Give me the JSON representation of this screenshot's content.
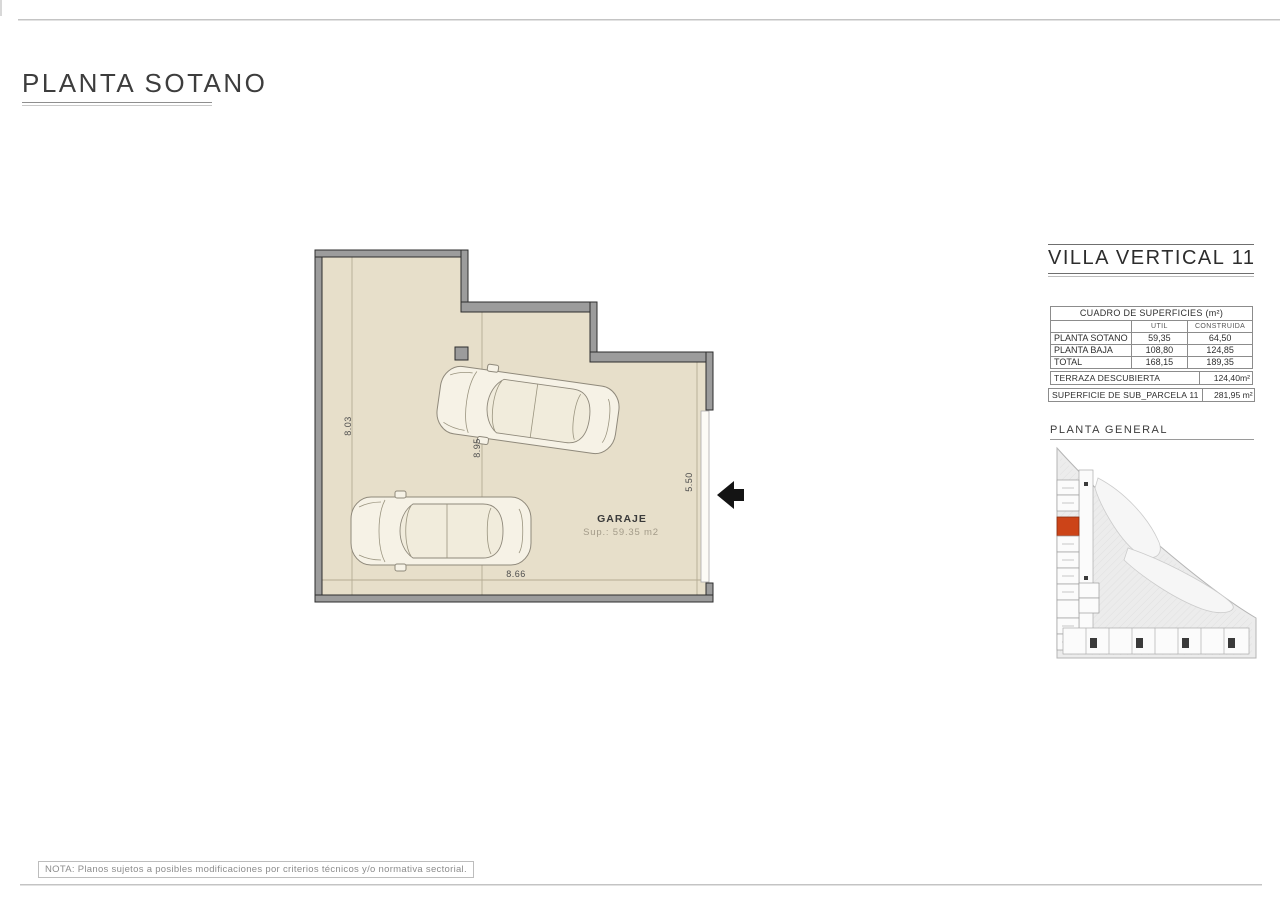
{
  "sheet": {
    "title": "PLANTA SOTANO",
    "note": "NOTA: Planos sujetos a posibles modificaciones por criterios técnicos y/o normativa sectorial."
  },
  "plan": {
    "room_label": "GARAJE",
    "room_area": "Sup.: 59.35 m2",
    "dims": {
      "left": "8.03",
      "inner": "8.95",
      "right": "5.50",
      "bottom": "8.66"
    }
  },
  "panel": {
    "title": "VILLA VERTICAL 11",
    "table": {
      "title": "CUADRO DE SUPERFICIES (m²)",
      "col_headers": [
        "UTIL",
        "CONSTRUIDA"
      ],
      "rows": [
        {
          "label": "PLANTA SOTANO",
          "util": "59,35",
          "construida": "64,50"
        },
        {
          "label": "PLANTA BAJA",
          "util": "108,80",
          "construida": "124,85"
        },
        {
          "label": "TOTAL",
          "util": "168,15",
          "construida": "189,35"
        }
      ]
    },
    "terraza": {
      "label": "TERRAZA DESCUBIERTA",
      "value": "124,40m²"
    },
    "parcela": {
      "label": "SUPERFICIE DE SUB_PARCELA  11",
      "value": "281,95 m²"
    },
    "general_title": "PLANTA GENERAL"
  },
  "colors": {
    "floor": "#e7dfca",
    "wall": "#9c9c9c",
    "highlight": "#cc4418"
  }
}
